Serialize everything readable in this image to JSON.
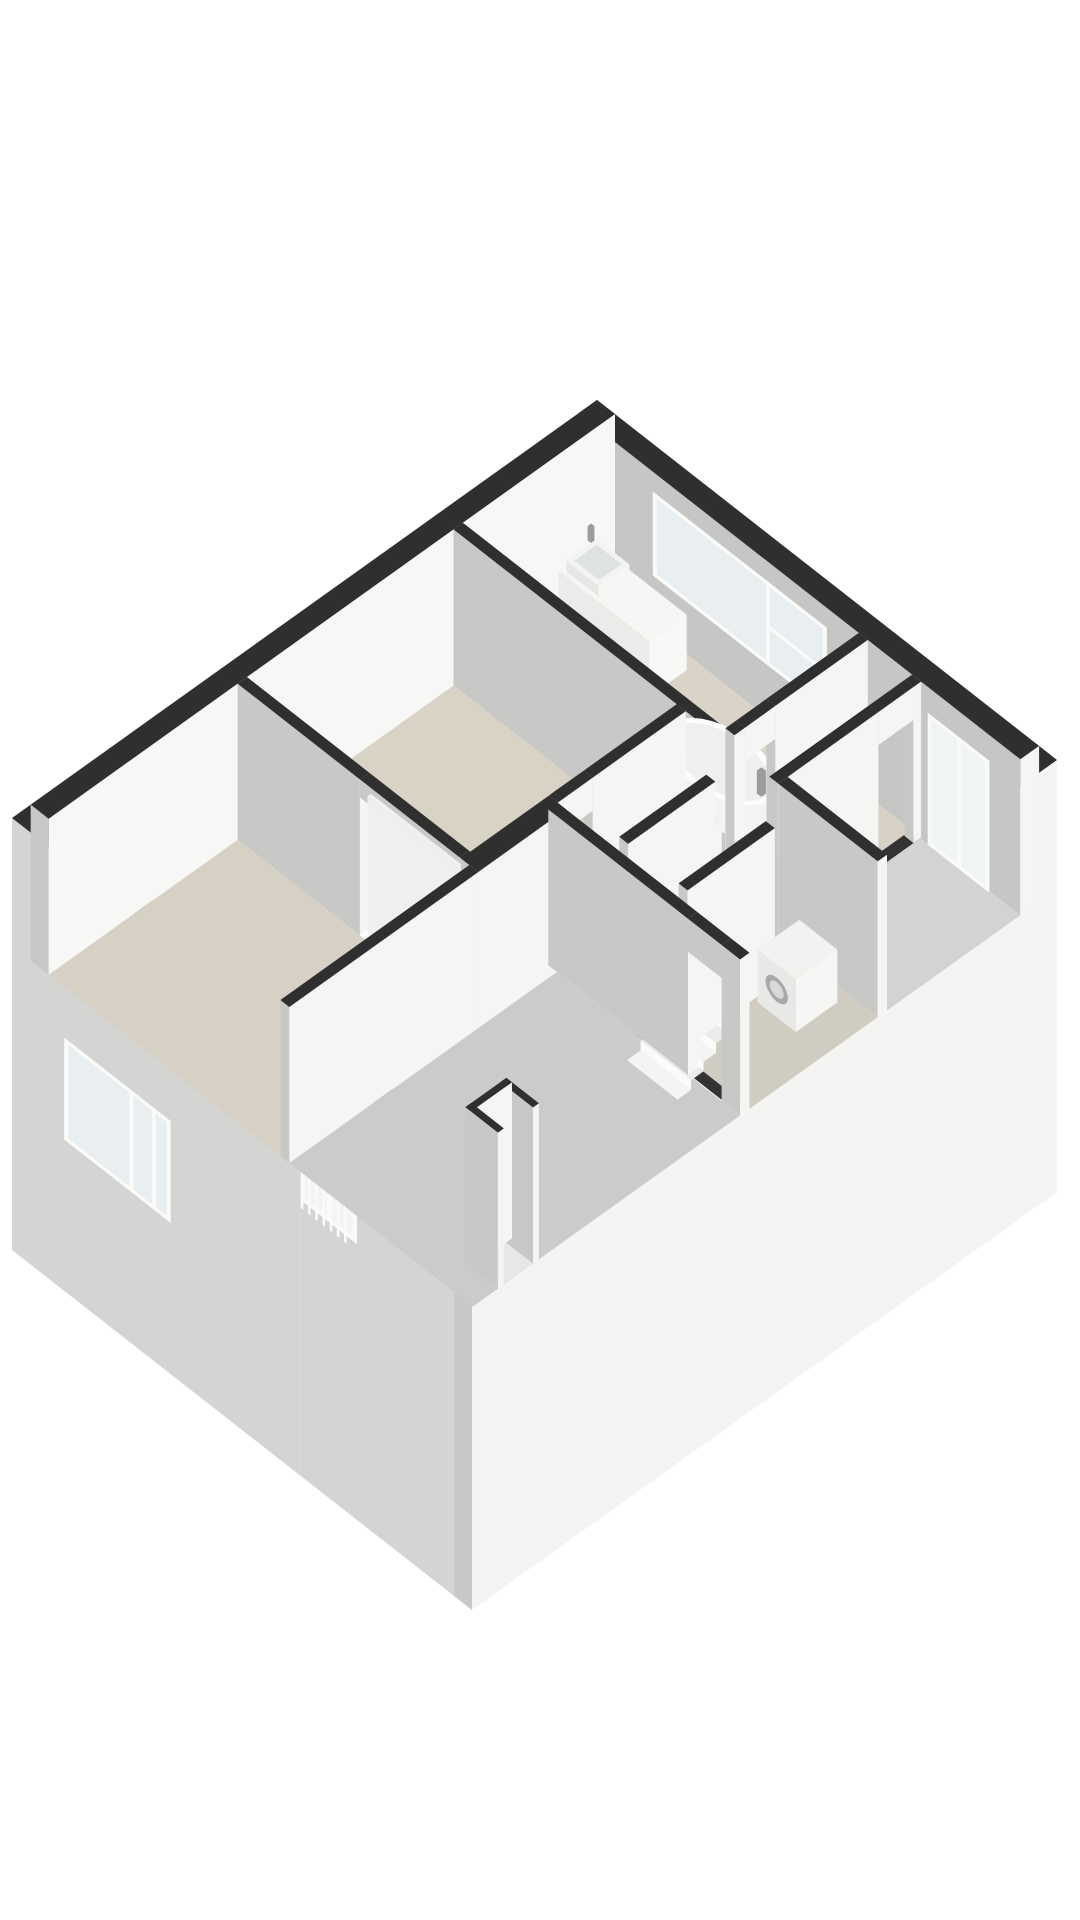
{
  "page": {
    "background": "#ffffff"
  },
  "colors": {
    "wallTop": "#2f2f2f",
    "faceGrey": "#c8c8c7",
    "faceWhite": "#f5f5f4",
    "topLight": "#f0f0ee",
    "extSWGrey": "#d4d4d3",
    "extSEWhite": "#f4f4f3",
    "neInnerGrey": "#c6c6c5",
    "nwInnerWhite": "#f7f7f6",
    "glass": "#e9eef1",
    "frame": "#fafaf9",
    "voidCol": "#2e2e2e",
    "threshold": "#333333",
    "riser": "#fbfbfa",
    "treadA": "#f4f4f2",
    "treadB": "#ebebe9",
    "tubSide": "#f3f3f1",
    "tubRim": "#fcfcfb",
    "tubInner": "#eef0f0",
    "metal": "#9a9a98",
    "backing": "#ececea",
    "basinRecess": "#dfe2e2",
    "washerRing": "#a8a8a6",
    "washerGlassDoor": "#d9d9d7"
  },
  "projection": {
    "origin": [
      597,
      556
    ],
    "u": [
      -58.5,
      41.8
    ],
    "v": [
      56.1,
      43.9
    ],
    "z": 60,
    "wallHeight": 2.6,
    "skirtDepth": 4.6
  },
  "scene": {
    "exterior_walls": [
      {
        "name": "wall-sw-exterior",
        "rect": [
          9.68,
          0,
          10,
          8.2
        ],
        "z": [
          -4.6,
          2.6
        ],
        "cu": "extSWGrey",
        "cv": "faceWhite",
        "openings": [
          {
            "a": 5.15,
            "b": 6.15,
            "z": [
              0,
              2.2
            ]
          }
        ]
      },
      {
        "name": "wall-se-exterior",
        "rect": [
          0,
          7.88,
          10,
          8.2
        ],
        "z": [
          -4.6,
          2.6
        ],
        "cu": "faceGrey",
        "cv": "extSEWhite",
        "key": 1
      }
    ],
    "exterior_decor": [
      {
        "type": "backing",
        "name": "sw-juliet-backing",
        "plane": "u",
        "at": 10.0,
        "r": [
          5.15,
          6.15
        ],
        "z": [
          0,
          2.2
        ],
        "fill": "backing",
        "key": 2
      },
      {
        "type": "glazing",
        "name": "sw-juliet-door",
        "plane": "u",
        "at": 10.0,
        "r": [
          5.15,
          6.15
        ],
        "z": [
          0,
          2.2
        ],
        "f": 0.08,
        "op": 0.5,
        "mullions": [
          5.65
        ],
        "transoms": [],
        "key": 3
      },
      {
        "type": "bars",
        "name": "sw-juliet-balustrade",
        "plane": "u",
        "at": 10.09,
        "r": [
          5.2,
          6.1
        ],
        "z": [
          0,
          1.02
        ],
        "n": 7,
        "rail": 0.08,
        "key": 4
      },
      {
        "type": "glazing",
        "name": "sw-skirt-window",
        "plane": "u",
        "at": 10.02,
        "r": [
          0.95,
          2.85
        ],
        "z": [
          -2.05,
          -0.35
        ],
        "f": 0.07,
        "op": 1,
        "mullions": [
          2.15,
          2.55
        ],
        "transoms": [],
        "key": 5
      }
    ],
    "floors": [
      {
        "name": "floor-bathroom",
        "rect": [
          0.32,
          0.32,
          2.6,
          5.0
        ],
        "fill": "#dad4c8"
      },
      {
        "name": "floor-corridor",
        "rect": [
          0.32,
          5.16,
          2.6,
          5.95
        ],
        "fill": "#d8d2c6"
      },
      {
        "name": "floor-bedroom3",
        "rect": [
          0.32,
          6.11,
          2.6,
          7.88
        ],
        "fill": "#d3d4d1"
      },
      {
        "name": "floor-bedroom1",
        "rect": [
          2.76,
          0.32,
          6.29,
          4.3
        ],
        "fill": "#d9d3c6"
      },
      {
        "name": "floor-landing",
        "rect": [
          2.76,
          4.46,
          4.95,
          7.88
        ],
        "fill": "#d1ccc1"
      },
      {
        "name": "floor-bedroom2",
        "rect": [
          6.45,
          0.32,
          9.68,
          4.45
        ],
        "fill": "#d7d1c5"
      },
      {
        "name": "floor-greyroom",
        "rect": [
          5.11,
          4.61,
          9.68,
          7.88
        ],
        "fill": "#c9ccc8"
      },
      {
        "name": "floor-wc-shaft",
        "rect": [
          2.9,
          4.6,
          3.3,
          5.04
        ],
        "fill": "#d8d2c6"
      },
      {
        "name": "floor-shaft2",
        "rect": [
          8.65,
          7.4,
          9.15,
          7.88
        ],
        "fill": "#e7e7e5"
      },
      {
        "name": "stairwell-void",
        "rect": [
          3.3,
          5.55,
          4.79,
          6.45
        ],
        "fill": "#2e2e2e"
      }
    ],
    "thresholds": [
      {
        "name": "threshold-bathroom-door",
        "rect": [
          1.9,
          5.0,
          2.42,
          5.16
        ]
      },
      {
        "name": "threshold-bedroom3-door",
        "rect": [
          0.45,
          5.95,
          1.05,
          6.11
        ]
      },
      {
        "name": "threshold-bedroom1-door",
        "rect": [
          4.35,
          4.3,
          4.87,
          4.46
        ]
      },
      {
        "name": "threshold-greyroom-door",
        "rect": [
          4.95,
          6.95,
          5.11,
          7.55
        ]
      }
    ],
    "blocks": [
      {
        "name": "wall-ne-exterior",
        "rect": [
          0,
          0,
          0.32,
          7.88
        ],
        "cu": "neInnerGrey",
        "key": 0
      },
      {
        "name": "wall-nw-exterior",
        "rect": [
          0,
          0,
          9.68,
          0.32
        ],
        "cv": "nwInnerWhite",
        "key": 0.1
      },
      {
        "name": "vanity-counter",
        "rect": [
          0.5,
          0.5,
          1.14,
          2.12
        ],
        "z": [
          0,
          0.92
        ],
        "ct": "#f6f6f4",
        "cu": "#ebebe9",
        "cv": "#f8f8f6",
        "key": 1.0
      },
      {
        "name": "sink-basin",
        "rect": [
          0.56,
          0.58,
          1.08,
          1.16
        ],
        "z": [
          0.92,
          1.1
        ],
        "ct": "#f3f3f1",
        "cu": "#e7e7e5",
        "cv": "#f7f7f5",
        "key": 1.1
      },
      {
        "name": "sink-faucet",
        "rect": [
          0.6,
          0.52,
          0.66,
          0.58
        ],
        "z": [
          1.1,
          1.34
        ],
        "ct": "metal",
        "cu": "metal",
        "cv": "metal",
        "key": 1.2
      },
      {
        "name": "wall-bathroom-sw",
        "rect": [
          2.6,
          0.32,
          2.76,
          5.16
        ],
        "key": 2.92
      },
      {
        "name": "wall-bathroom-se",
        "rect": [
          0.32,
          5.0,
          2.6,
          5.16
        ],
        "key": 5.32,
        "openings": [
          {
            "a": 1.9,
            "b": 2.42,
            "z": [
              0,
              2.05
            ]
          }
        ]
      },
      {
        "name": "wall-bedroom3-nw",
        "rect": [
          0.32,
          5.95,
          2.76,
          6.11
        ],
        "key": 6.27,
        "openings": [
          {
            "a": 0.45,
            "b": 1.05,
            "z": [
              0,
              2.05
            ]
          }
        ]
      },
      {
        "name": "wall-bedroom3-sw",
        "rect": [
          2.6,
          6.11,
          2.76,
          7.88
        ],
        "key": 8.71
      },
      {
        "name": "wall-bedroom1-se",
        "rect": [
          2.76,
          4.3,
          4.95,
          4.46
        ],
        "key": 7.06,
        "openings": [
          {
            "a": 4.35,
            "b": 4.87,
            "z": [
              0,
              2.05
            ]
          }
        ]
      },
      {
        "name": "wall-center-block",
        "rect": [
          4.95,
          4.3,
          6.45,
          4.61
        ],
        "key": 9.25
      },
      {
        "name": "wall-bedroom-divider",
        "rect": [
          6.29,
          0.32,
          6.45,
          4.46
        ],
        "key": 6.61,
        "openings": [
          {
            "a": 2.5,
            "b": 4.28,
            "z": [
              0,
              2.3
            ]
          }
        ]
      },
      {
        "name": "sliding-door-panel",
        "rect": [
          6.31,
          2.55,
          6.37,
          4.25
        ],
        "z": [
          0,
          2.3
        ],
        "ct": "topLight",
        "cu": "#efefed",
        "cv": "#fafaf8",
        "key": 8.87
      },
      {
        "name": "wall-bedroom2-se",
        "rect": [
          6.45,
          4.45,
          9.68,
          4.61
        ],
        "key": 9.5
      },
      {
        "name": "wall-greyroom-ne",
        "rect": [
          4.95,
          4.46,
          5.11,
          7.88
        ],
        "key": 9.8,
        "openings": [
          {
            "a": 6.95,
            "b": 7.55,
            "z": [
              0,
              2.05
            ]
          }
        ]
      },
      {
        "name": "wall-stair-nw",
        "rect": [
          3.3,
          5.39,
          4.79,
          5.55
        ],
        "key": 8.69
      },
      {
        "name": "wall-stair-se",
        "rect": [
          3.3,
          6.45,
          4.79,
          6.61
        ],
        "key": 9.75
      },
      {
        "name": "wc-shaft-wall-ne",
        "rect": [
          2.8,
          4.5,
          2.9,
          5.14
        ],
        "z": [
          0,
          1.3
        ],
        "ct": "topLight",
        "key": 7.3
      },
      {
        "name": "wc-shaft-wall-nw",
        "rect": [
          2.8,
          4.5,
          3.4,
          4.6
        ],
        "z": [
          0,
          1.3
        ],
        "ct": "topLight",
        "key": 7.31
      },
      {
        "name": "wc-shaft-wall-sw",
        "rect": [
          3.3,
          4.5,
          3.4,
          5.14
        ],
        "z": [
          0,
          1.3
        ],
        "ct": "topLight",
        "key": 7.8
      },
      {
        "name": "wc-shaft-wall-se",
        "rect": [
          2.8,
          5.04,
          3.4,
          5.14
        ],
        "z": [
          0,
          1.3
        ],
        "ct": "topLight",
        "key": 7.84
      },
      {
        "name": "shaft2-wall-ne",
        "rect": [
          8.55,
          7.3,
          8.65,
          7.88
        ],
        "key": 15.85
      },
      {
        "name": "shaft2-wall-nw",
        "rect": [
          8.55,
          7.3,
          9.25,
          7.4
        ],
        "key": 15.86
      },
      {
        "name": "shaft2-wall-sw",
        "rect": [
          9.15,
          7.3,
          9.25,
          7.88
        ],
        "key": 16.45
      },
      {
        "name": "washing-machine",
        "rect": [
          2.95,
          6.68,
          3.66,
          7.36
        ],
        "z": [
          0,
          0.88
        ],
        "ct": "#f2f2f0",
        "cu": "#e8e8e6",
        "cv": "#f6f6f4",
        "key": 10.0
      },
      {
        "name": "bathtub-faucet",
        "rect": [
          1.6,
          4.6,
          1.68,
          4.68
        ],
        "z": [
          0.58,
          0.96
        ],
        "ct": "metal",
        "cu": "metal",
        "cv": "metal",
        "key": 4.9
      }
    ],
    "interior_decor": [
      {
        "type": "bars",
        "name": "ne-juliet-balustrade",
        "plane": "u",
        "at": 0.3,
        "r": [
          6.3,
          7.3
        ],
        "z": [
          0,
          1.02
        ],
        "n": 7,
        "rail": 0.08,
        "key": 0.55
      },
      {
        "type": "glazing",
        "name": "ne-juliet-door",
        "plane": "u",
        "at": 0.34,
        "r": [
          6.25,
          7.35
        ],
        "z": [
          0,
          2.2
        ],
        "f": 0.07,
        "op": 0.55,
        "mullions": [
          6.8
        ],
        "transoms": [],
        "key": 0.6
      },
      {
        "type": "glazing",
        "name": "bathroom-window",
        "plane": "u",
        "at": 0.34,
        "r": [
          1.35,
          4.45
        ],
        "z": [
          0.9,
          2.3
        ],
        "f": 0.07,
        "op": 1,
        "mullions": [
          3.4
        ],
        "transoms": [
          [
            3.4,
            4.45,
            1.55
          ]
        ],
        "key": 0.62
      }
    ],
    "stairs": {
      "name": "staircase",
      "u": [
        3.3,
        4.79
      ],
      "v": [
        5.55,
        6.45
      ],
      "treads": 7,
      "rise": 0.16,
      "key": 8.8
    },
    "tub": {
      "name": "bathtub",
      "cu": 1.64,
      "cv": 3.92,
      "ru": 0.5,
      "rv": 0.88,
      "ztop": 0.58,
      "key": 4.2
    },
    "washer_door": {
      "name": "washing-machine-door",
      "at": 3.66,
      "cv": 7.02,
      "cz": 0.46,
      "rv": 0.2,
      "rz": 0.2,
      "key": 10.05
    },
    "basin_recess": {
      "name": "sink-basin-recess",
      "rect": [
        0.63,
        0.65,
        1.01,
        1.09
      ],
      "z": 1.101,
      "key": 1.15
    }
  }
}
